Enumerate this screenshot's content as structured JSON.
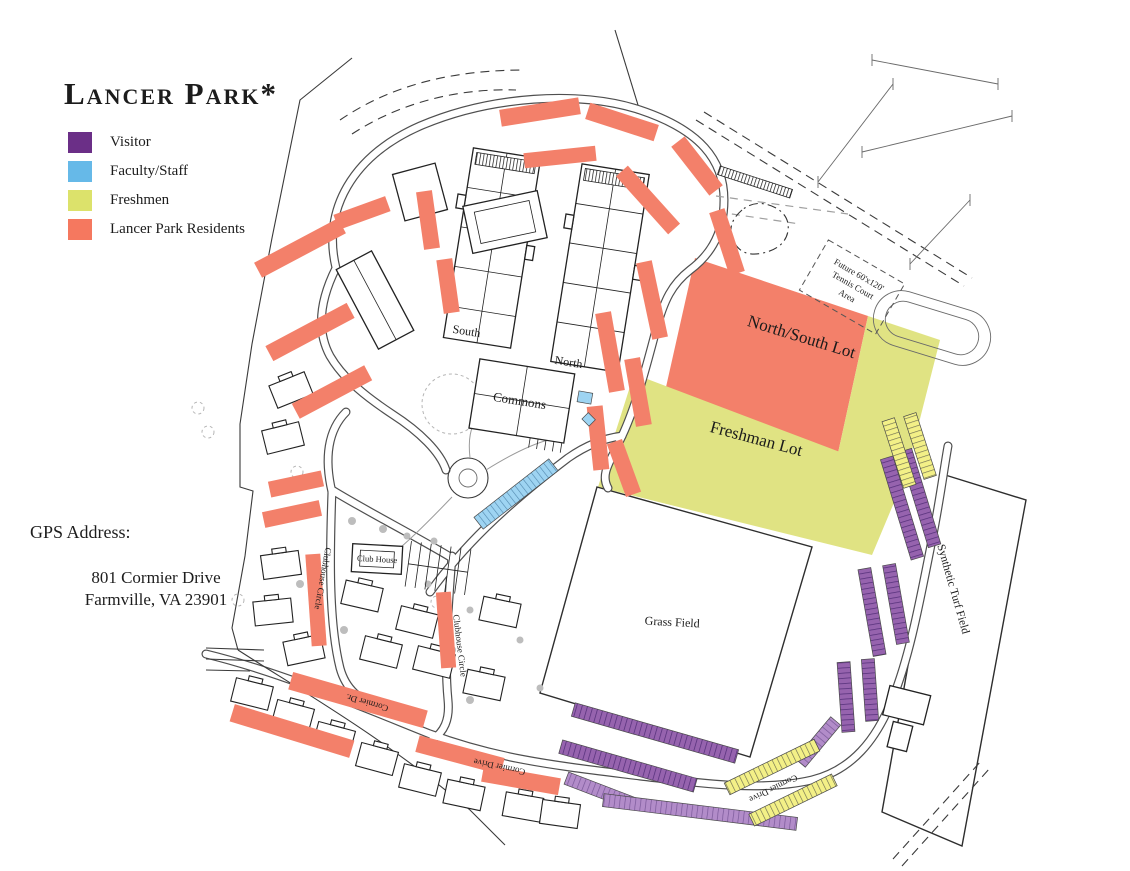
{
  "title": "Lancer Park*",
  "legend": {
    "items": [
      {
        "label": "Visitor",
        "color": "#6B2F87"
      },
      {
        "label": "Faculty/Staff",
        "color": "#66B9E8"
      },
      {
        "label": "Freshmen",
        "color": "#DCE26B"
      },
      {
        "label": "Lancer Park Residents",
        "color": "#F5785F"
      }
    ]
  },
  "gps": {
    "heading": "GPS Address:",
    "line1": "801 Cormier Drive",
    "line2": "Farmville, VA 23901"
  },
  "map": {
    "lots": {
      "north_south": "North/South Lot",
      "freshman": "Freshman Lot"
    },
    "fields": {
      "grass": "Grass Field",
      "turf": "Synthetic Turf Field"
    },
    "buildings": {
      "south": "South",
      "north": "North",
      "commons": "Commons",
      "club_house": "Club House"
    },
    "roads": {
      "clubhouse_circle": "Clubhouse Circle",
      "cormier_dr": "Cormier Dr.",
      "cormier_drive": "Cormier Drive"
    },
    "notes": {
      "tennis_line1": "Future 60'x120'",
      "tennis_line2": "Tennis Court",
      "tennis_line3": "Area"
    },
    "colors": {
      "residents_fill": "#F3806A",
      "freshman_fill": "#E0E383",
      "visitor_stripe_fill": "#9663AE",
      "faculty_stripe_fill": "#9ED4F2",
      "freshman_stripe_fill": "#F3F087"
    }
  }
}
